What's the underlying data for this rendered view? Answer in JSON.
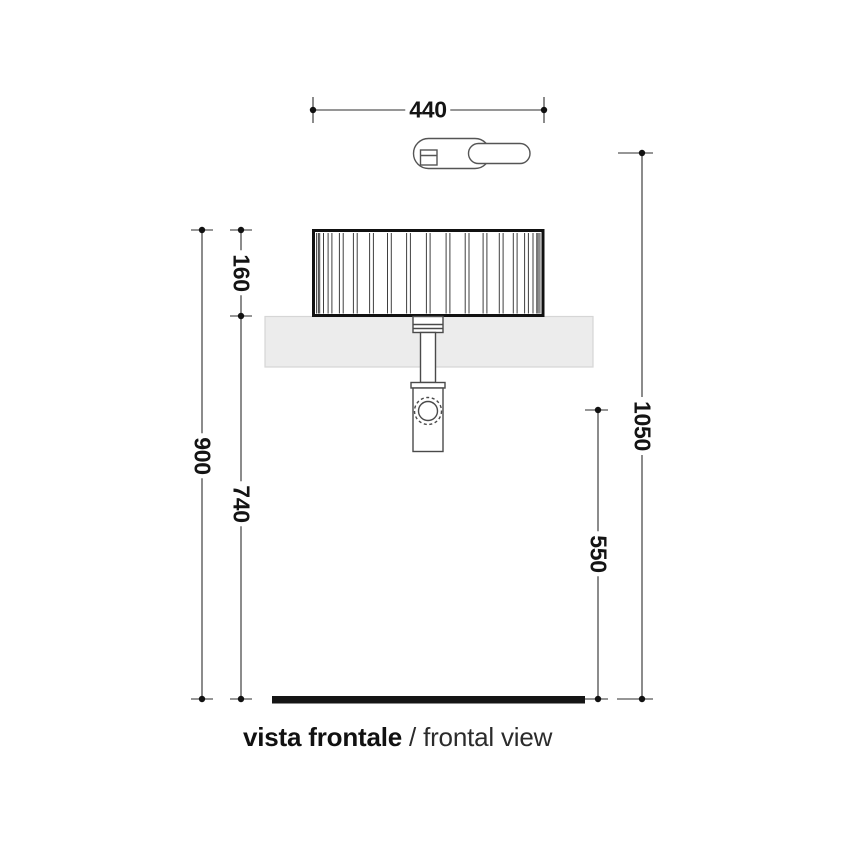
{
  "drawing": {
    "type": "technical-dimension-drawing",
    "subject": "countertop washbasin with wall mixer, frontal elevation"
  },
  "dimensions": {
    "faucet_width": "440",
    "basin_height": "160",
    "basin_rim_height": "900",
    "countertop_height": "740",
    "drain_outlet_height": "550",
    "mixer_height": "1050"
  },
  "caption": {
    "primary": "vista frontale",
    "secondary": "/ frontal view"
  },
  "colors": {
    "line": "#2e2e2e",
    "basin_outline": "#111111",
    "fixture_stroke": "#555555",
    "countertop_fill": "#ececec",
    "countertop_stroke": "#d6d6d6",
    "floor": "#151515",
    "text": "#141414",
    "background": "#ffffff"
  }
}
